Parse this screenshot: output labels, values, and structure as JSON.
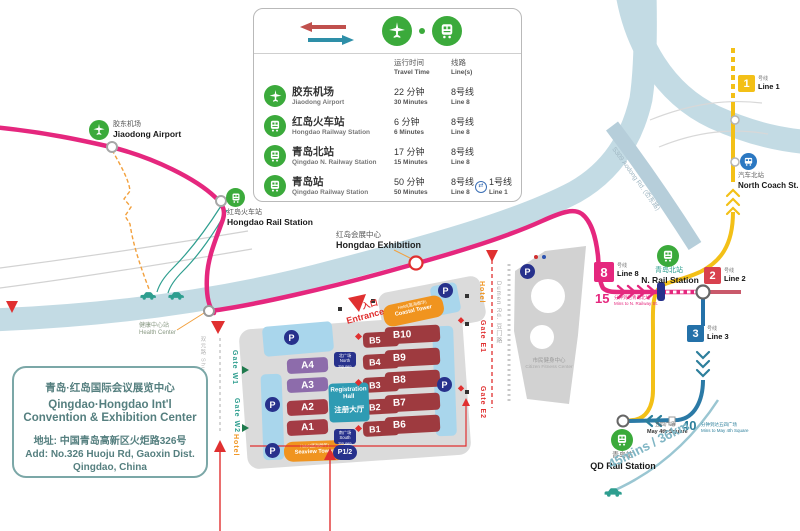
{
  "colors": {
    "line8_pink": "#E5277E",
    "line1_yellow": "#F3C017",
    "line2_red": "#D8414E",
    "line3_blue": "#2471A9",
    "teal": "#2C7F9B",
    "green": "#3BAA3B",
    "orange": "#F0941F",
    "navy": "#27318C",
    "road": "#C3DBE4",
    "red": "#E03030"
  },
  "legend": {
    "header": {
      "time_cn": "运行时间",
      "time_en": "Travel Time",
      "line_cn": "线路",
      "line_en": "Line(s)"
    },
    "rows": [
      {
        "cn": "胶东机场",
        "en": "Jiaodong Airport",
        "time_cn": "22 分钟",
        "time_en": "30 Minutes",
        "line_cn": "8号线",
        "line_en": "Line 8"
      },
      {
        "cn": "红岛火车站",
        "en": "Hongdao Railway Station",
        "time_cn": "6 分钟",
        "time_en": "6 Minutes",
        "line_cn": "8号线",
        "line_en": "Line 8"
      },
      {
        "cn": "青岛北站",
        "en": "Qingdao N. Railway Station",
        "time_cn": "17 分钟",
        "time_en": "15 Minutes",
        "line_cn": "8号线",
        "line_en": "Line 8"
      },
      {
        "cn": "青岛站",
        "en": "Qingdao Railway Station",
        "time_cn": "50 分钟",
        "time_en": "50 Minutes",
        "line_cn": "8号线",
        "line_en": "Line 8",
        "line2_cn": "1号线",
        "line2_en": "Line 1"
      }
    ]
  },
  "info_box": {
    "title_cn": "青岛·红岛国际会议展览中心",
    "title_en1": "Qingdao·Hongdao Int'l",
    "title_en2": "Convention & Exhibition Center",
    "addr_cn": "地址: 中国青岛高新区火炬路326号",
    "addr_en1": "Add: No.326 Huoju Rd, Gaoxin Dist.",
    "addr_en2": "Qingdao, China"
  },
  "stations": {
    "jiaodong": {
      "cn": "胶东机场",
      "en": "Jiaodong Airport"
    },
    "hongdao_rail": {
      "cn": "红岛火车站",
      "en": "Hongdao Rail Station"
    },
    "health": {
      "cn": "健康中心站",
      "en": "Health Center"
    },
    "exhibition": {
      "cn": "红岛会展中心",
      "en": "Hongdao Exhibition"
    },
    "n_rail": {
      "cn": "青岛北站",
      "en": "N. Rail Station"
    },
    "qd_rail": {
      "cn": "青岛站",
      "en": "QD Rail Station"
    },
    "north_coach": {
      "cn": "汽车北站",
      "en": "North Coach St."
    },
    "may4": {
      "cn": "五四广场",
      "en": "May 4th Square"
    }
  },
  "lines": {
    "l1": {
      "n": "1",
      "cn": "号线",
      "en": "Line 1"
    },
    "l2": {
      "n": "2",
      "cn": "号线",
      "en": "Line 2"
    },
    "l3": {
      "n": "3",
      "cn": "号线",
      "en": "Line 3"
    },
    "l8": {
      "n": "8",
      "cn": "号线",
      "en": "Line 8"
    }
  },
  "notes": {
    "to_nrail": {
      "n": "15",
      "cn": "分钟到达青岛北站",
      "en": "Mins to N. Railway St."
    },
    "to_may4": {
      "n": "40",
      "cn": "分钟到达五四广场",
      "en": "Mins to May 4th Square"
    },
    "drive": "45mins / 36km"
  },
  "roads": {
    "huoju": "Huoju Rd. (火炬路)",
    "aodong": "S309 Aodong Rd. (岙东路)",
    "dumen": "Dumen Rd. 豆门路",
    "shuangyuan": "双元路 Shuangyuan Rd"
  },
  "complex": {
    "entrance_cn": "入口",
    "entrance_en": "Entrance",
    "halls": {
      "a1": "A1",
      "a2": "A2",
      "a3": "A3",
      "a4": "A4",
      "b1": "B1",
      "b2": "B2",
      "b3": "B3",
      "b4": "B4",
      "b5": "B5",
      "b6": "B6",
      "b7": "B7",
      "b8": "B8",
      "b9": "B9",
      "b10": "B10"
    },
    "registration": {
      "en1": "Registration",
      "en2": "Hall",
      "cn": "注册大厅"
    },
    "coastal": {
      "cn": "Hotel(蓝海御华)",
      "en": "Coastal Tower"
    },
    "seaview": {
      "cn": "Hotel(蓝海御华)",
      "en": "Seaview Tower"
    },
    "gates": {
      "w1": "Gate W1",
      "w2": "Gate W2",
      "e1": "Gate E1",
      "e2": "Gate E2",
      "hotel": "Hotel"
    },
    "squares": {
      "north_cn": "北广场",
      "north_en": "North Square",
      "south_cn": "南广场",
      "south_en": "South Square"
    },
    "parking": {
      "p": "P",
      "p12": "P1/2"
    }
  },
  "fitness": {
    "cn": "市民健身中心",
    "en": "Citizen Fitness Center"
  }
}
